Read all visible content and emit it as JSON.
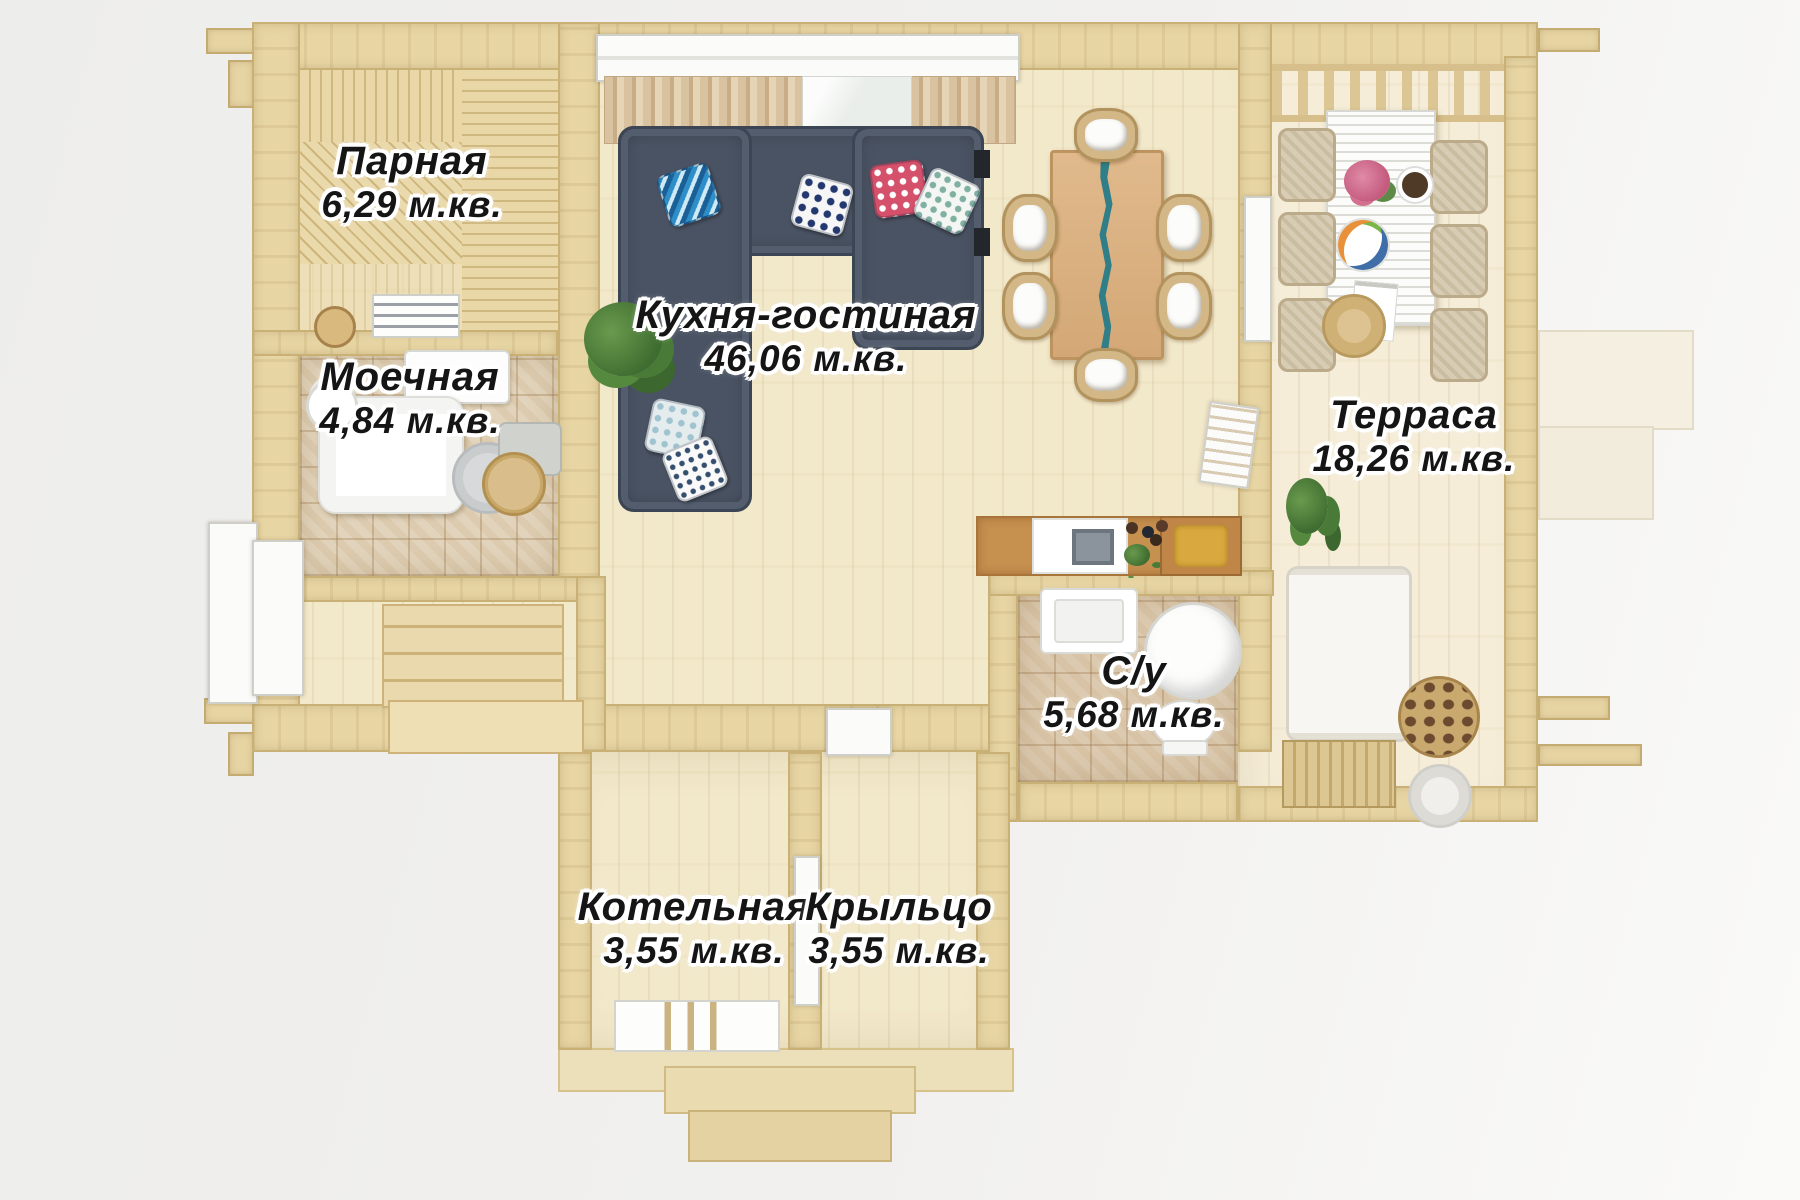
{
  "plan": {
    "rooms": [
      {
        "id": "parnaya",
        "label": "Парная",
        "area": "6,29 м.кв."
      },
      {
        "id": "moechnaya",
        "label": "Моечная",
        "area": "4,84 м.кв."
      },
      {
        "id": "kuhnya",
        "label": "Кухня-гостиная",
        "area": "46,06 м.кв."
      },
      {
        "id": "terrasa",
        "label": "Терраса",
        "area": "18,26 м.кв."
      },
      {
        "id": "su",
        "label": "С/у",
        "area": "5,68 м.кв."
      },
      {
        "id": "kotelnaya",
        "label": "Котельная",
        "area": "3,55 м.кв."
      },
      {
        "id": "kryltso",
        "label": "Крыльцо",
        "area": "3,55 м.кв."
      }
    ],
    "colors": {
      "wall": "#e7d5a4",
      "floor": "#f2e8ca",
      "sofa": "#4a5363",
      "table_river": "#2f7e88",
      "counter": "#c6904f",
      "accent_gold": "#d9a93f",
      "label_text": "#151515",
      "label_outline": "#ffffff"
    }
  }
}
